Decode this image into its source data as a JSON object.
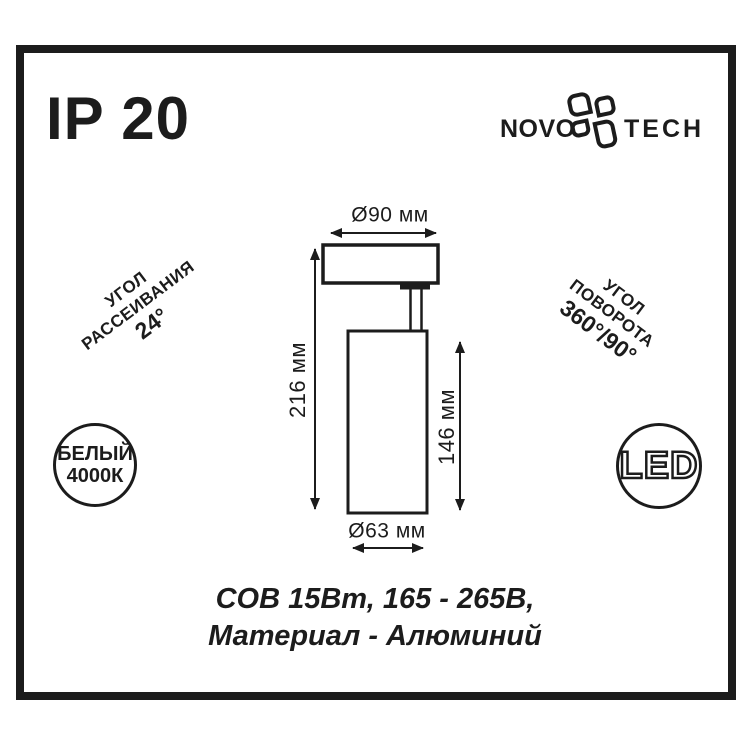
{
  "ip_rating": "IP 20",
  "logo": {
    "part1": "NOVO",
    "part2": "TECH",
    "icon": "novotech-flower-icon"
  },
  "beam_angle": {
    "line1": "УГОЛ",
    "line2": "РАССЕИВАНИЯ",
    "value": "24°"
  },
  "rotation_angle": {
    "line1": "УГОЛ",
    "line2": "ПОВОРОТА",
    "value": "360°/90°"
  },
  "color_temp_badge": {
    "line1": "БЕЛЫЙ",
    "line2": "4000К"
  },
  "led_badge": "LED",
  "drawing": {
    "top_diameter": "Ø90 мм",
    "overall_height": "216 мм",
    "body_height": "146 мм",
    "body_diameter": "Ø63 мм"
  },
  "specs": {
    "line1": "COB 15Вт, 165 - 265В,",
    "line2": "Материал - Алюминий"
  },
  "colors": {
    "ink": "#1c1c1c",
    "background": "#ffffff"
  }
}
